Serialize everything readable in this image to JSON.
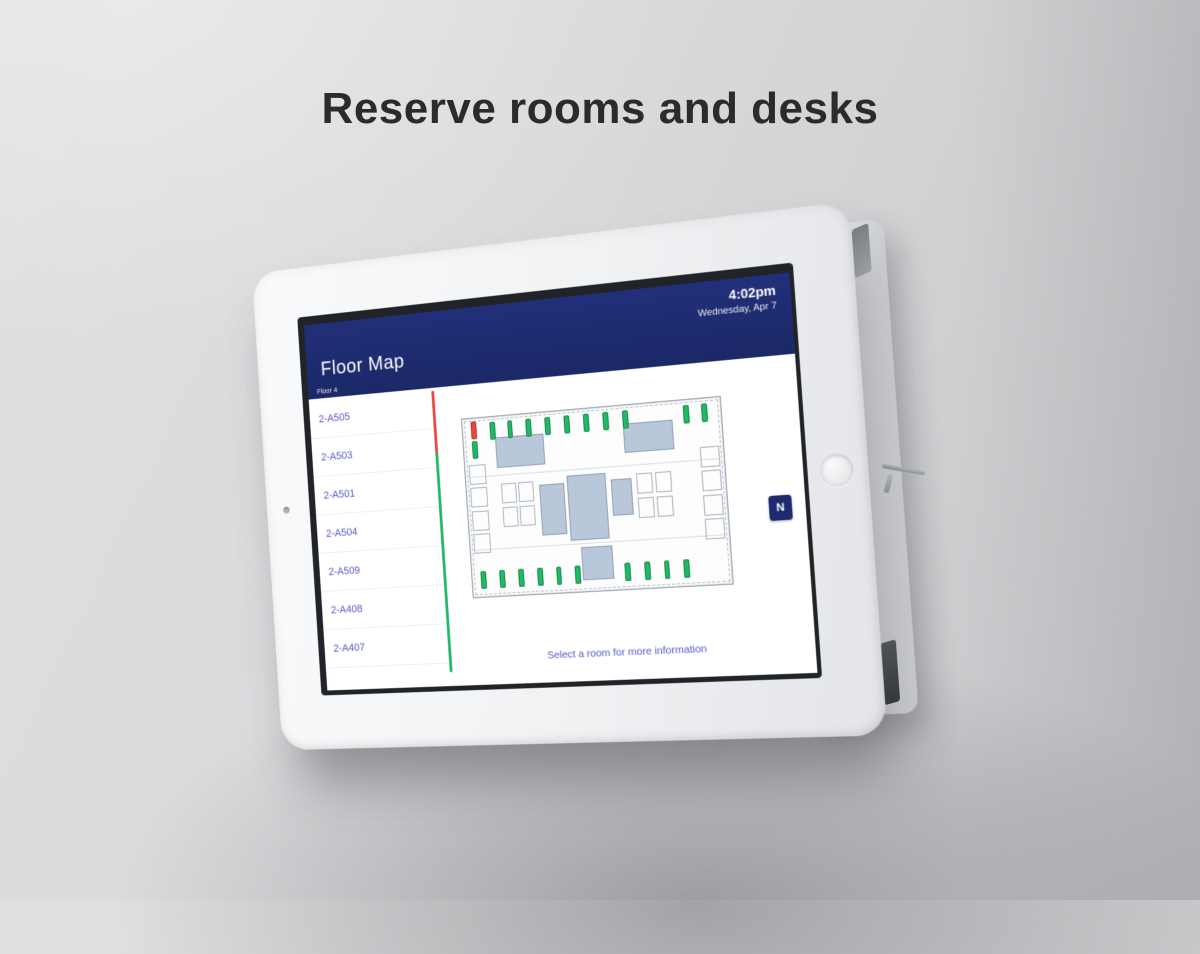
{
  "headline": "Reserve rooms and desks",
  "colors": {
    "header_navy": "#1d2b6e",
    "accent_green": "#21b866",
    "accent_red": "#e8493f",
    "link_blue": "#5558c8",
    "room_fill": "#b9c7da"
  },
  "kiosk": {
    "header": {
      "title": "Floor Map",
      "time": "4:02pm",
      "date": "Wednesday, Apr 7",
      "floor_label": "Floor 4"
    },
    "sidebar": {
      "rooms": [
        {
          "name": "2-A505"
        },
        {
          "name": "2-A503"
        },
        {
          "name": "2-A501"
        },
        {
          "name": "2-A504"
        },
        {
          "name": "2-A509"
        },
        {
          "name": "2-A408"
        },
        {
          "name": "2-A407"
        }
      ],
      "timeline": {
        "busy_percent": 22
      }
    },
    "map": {
      "compass_label": "N",
      "footer_hint": "Select a room for more information",
      "rooms": [
        {
          "x": 13,
          "y": 12,
          "w": 19,
          "h": 17
        },
        {
          "x": 63,
          "y": 10,
          "w": 19,
          "h": 16
        },
        {
          "x": 40,
          "y": 36,
          "w": 15,
          "h": 36
        },
        {
          "x": 29,
          "y": 40,
          "w": 10,
          "h": 28
        },
        {
          "x": 57,
          "y": 40,
          "w": 8,
          "h": 20
        },
        {
          "x": 44,
          "y": 76,
          "w": 12,
          "h": 18
        }
      ],
      "outline_rooms": [
        {
          "x": 1.5,
          "y": 26,
          "w": 7,
          "h": 11
        },
        {
          "x": 1.5,
          "y": 39,
          "w": 7,
          "h": 11
        },
        {
          "x": 1.5,
          "y": 52,
          "w": 7,
          "h": 11
        },
        {
          "x": 1.5,
          "y": 65,
          "w": 7,
          "h": 11
        },
        {
          "x": 91.5,
          "y": 26,
          "w": 7,
          "h": 11
        },
        {
          "x": 91.5,
          "y": 39,
          "w": 7,
          "h": 11
        },
        {
          "x": 91.5,
          "y": 52,
          "w": 7,
          "h": 11
        },
        {
          "x": 91.5,
          "y": 65,
          "w": 7,
          "h": 11
        },
        {
          "x": 14,
          "y": 38,
          "w": 6,
          "h": 11
        },
        {
          "x": 21,
          "y": 38,
          "w": 6,
          "h": 11
        },
        {
          "x": 14,
          "y": 51,
          "w": 6,
          "h": 11
        },
        {
          "x": 21,
          "y": 51,
          "w": 6,
          "h": 11
        },
        {
          "x": 67,
          "y": 38,
          "w": 6,
          "h": 11
        },
        {
          "x": 74,
          "y": 38,
          "w": 6,
          "h": 11
        },
        {
          "x": 67,
          "y": 51,
          "w": 6,
          "h": 11
        },
        {
          "x": 74,
          "y": 51,
          "w": 6,
          "h": 11
        }
      ],
      "desks": [
        {
          "x": 3.5,
          "y": 2,
          "status": "busy"
        },
        {
          "x": 3.5,
          "y": 13,
          "status": "available"
        },
        {
          "x": 11,
          "y": 3,
          "status": "available"
        },
        {
          "x": 18,
          "y": 3,
          "status": "available"
        },
        {
          "x": 25.5,
          "y": 3,
          "status": "available"
        },
        {
          "x": 33,
          "y": 3,
          "status": "available"
        },
        {
          "x": 40.5,
          "y": 3,
          "status": "available"
        },
        {
          "x": 48,
          "y": 3,
          "status": "available"
        },
        {
          "x": 55.5,
          "y": 3,
          "status": "available"
        },
        {
          "x": 63,
          "y": 3,
          "status": "available"
        },
        {
          "x": 86,
          "y": 3,
          "status": "available"
        },
        {
          "x": 93,
          "y": 3,
          "status": "available"
        },
        {
          "x": 3.5,
          "y": 86,
          "status": "available"
        },
        {
          "x": 11,
          "y": 86,
          "status": "available"
        },
        {
          "x": 18.5,
          "y": 86,
          "status": "available"
        },
        {
          "x": 26,
          "y": 86,
          "status": "available"
        },
        {
          "x": 33.5,
          "y": 86,
          "status": "available"
        },
        {
          "x": 41,
          "y": 86,
          "status": "available"
        },
        {
          "x": 60,
          "y": 86,
          "status": "available"
        },
        {
          "x": 67.5,
          "y": 86,
          "status": "available"
        },
        {
          "x": 75,
          "y": 86,
          "status": "available"
        },
        {
          "x": 82.5,
          "y": 86,
          "status": "available"
        }
      ]
    }
  }
}
